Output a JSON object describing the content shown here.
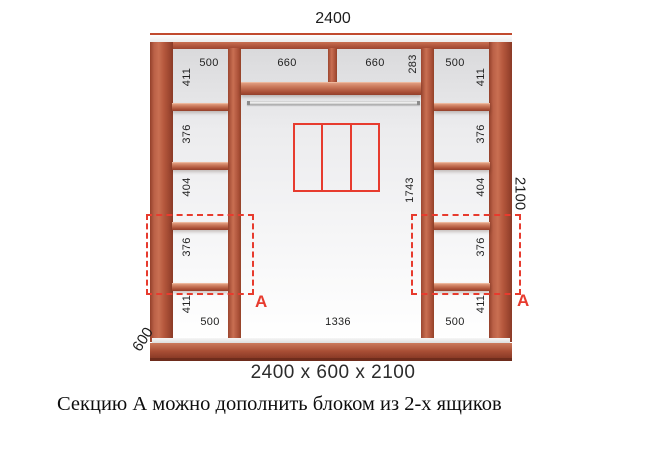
{
  "diagram": {
    "title_width": "2400",
    "height_label": "2100",
    "depth_label": "600",
    "size_summary": "2400 x 600 x 2100",
    "caption": "Секцию А можно дополнить блоком из 2-х ящиков",
    "section_marker": "А",
    "top_row": {
      "shelf_left_width": "660",
      "shelf_right_width": "660",
      "top_section_height": "283"
    },
    "middle": {
      "open_height": "1743",
      "bottom_width": "1336"
    },
    "left_column": {
      "top_width": "500",
      "bottom_width": "500",
      "sections": [
        "411",
        "376",
        "404",
        "376",
        "411"
      ]
    },
    "right_column": {
      "top_width": "500",
      "bottom_width": "500",
      "sections": [
        "411",
        "376",
        "404",
        "376",
        "411"
      ]
    },
    "colors": {
      "wood": "#b4573c",
      "accent_red": "#e73b2e",
      "label": "#222222"
    }
  }
}
